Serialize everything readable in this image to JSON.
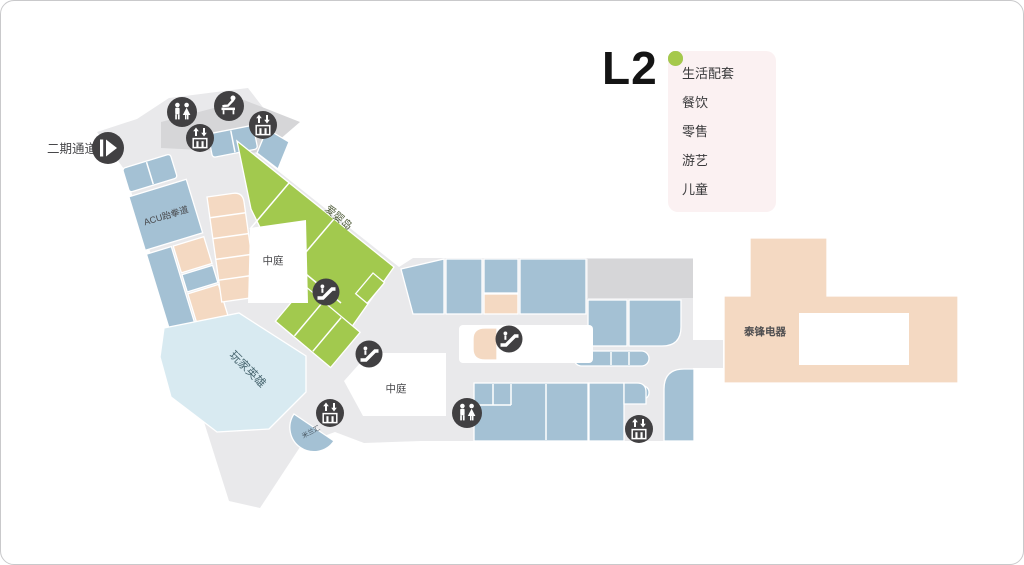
{
  "title": "L2",
  "legend": {
    "items": [
      {
        "label": "生活配套",
        "color": "#E9875F"
      },
      {
        "label": "餐饮",
        "color": "#9FC2CF"
      },
      {
        "label": "零售",
        "color": "#F2D5BC"
      },
      {
        "label": "游艺",
        "color": "#BFD8DD"
      },
      {
        "label": "儿童",
        "color": "#A5C94B"
      }
    ]
  },
  "map": {
    "labels": {
      "entrance": "二期通道",
      "acu": "ACU跆拳道",
      "baby_island": "爱婴岛",
      "atrium": "中庭",
      "player_hero": "玩家英雄",
      "milan_hui": "米兰汇",
      "taifeng": "泰锋电器"
    },
    "icons": {
      "restroom": "restroom-icon",
      "baby_care": "baby-care-icon",
      "elevator": "elevator-icon",
      "escalator": "escalator-icon",
      "entrance": "phase2-entrance-icon"
    }
  },
  "colors": {
    "dining_block": "#A4C1D4",
    "retail_block": "#F4D9C2",
    "amusement_block": "#D8EAF1",
    "kids_block": "#A2C94E",
    "floor": "#E9E9EB",
    "service_gray": "#D6D6D8",
    "icon_dark": "#414042",
    "legend_bg": "#FBF1F2"
  }
}
